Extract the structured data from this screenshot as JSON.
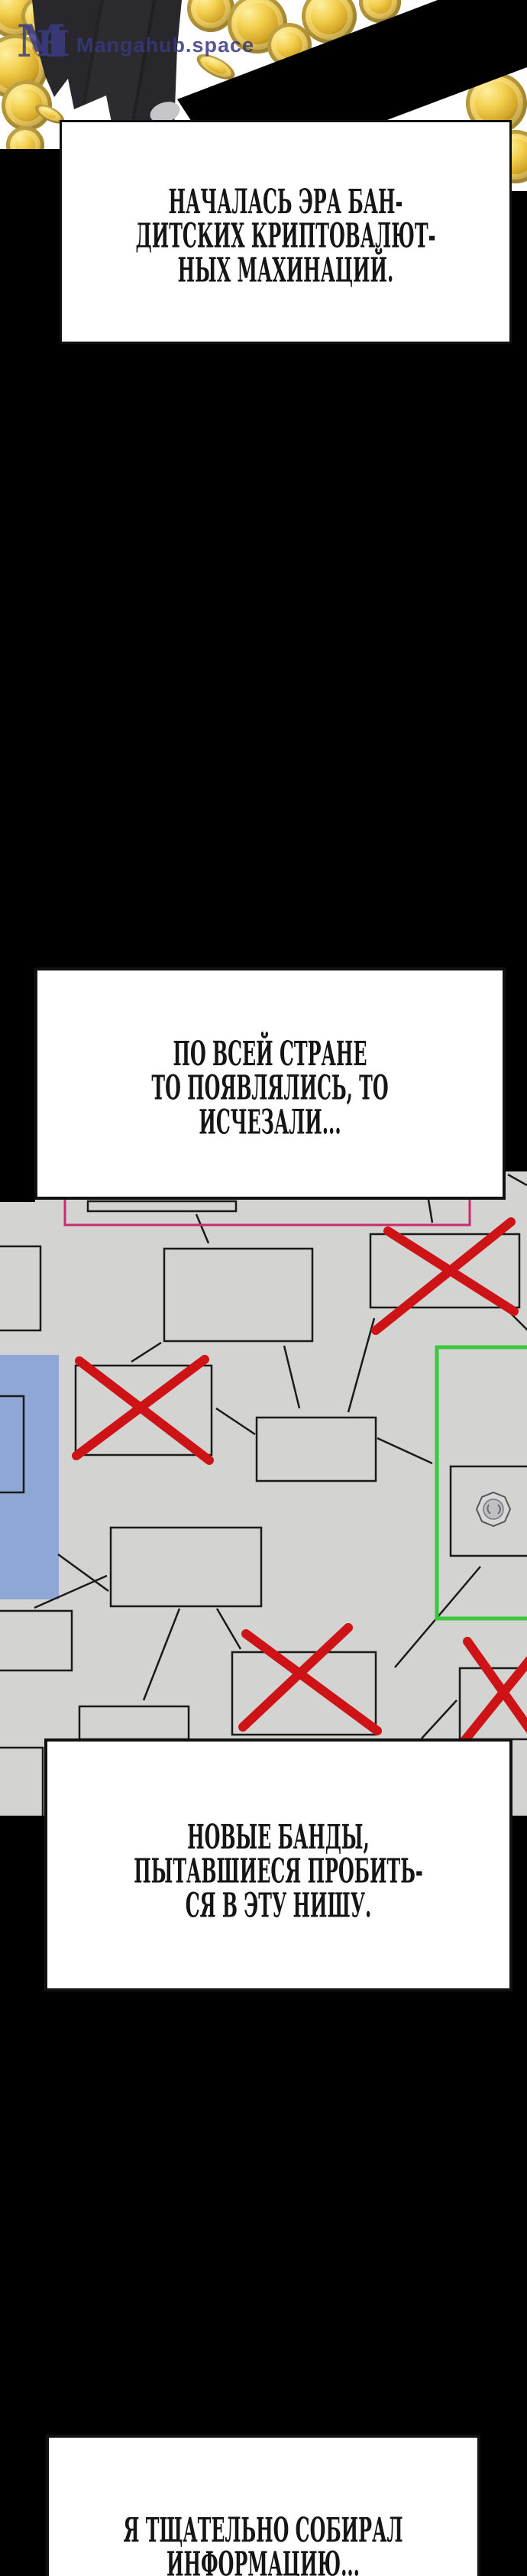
{
  "watermark": {
    "logo": "MH",
    "site": "Mangahub.space"
  },
  "captions": {
    "box1": {
      "lines": [
        "НАЧАЛАСЬ ЭРА БАН-",
        "ДИТСКИХ КРИПТОВАЛЮТ-",
        "НЫХ МАХИНАЦИЙ."
      ]
    },
    "box2": {
      "lines": [
        "ПО ВСЕЙ СТРАНЕ",
        "ТО ПОЯВЛЯЛИСЬ, ТО",
        "ИСЧЕЗАЛИ..."
      ]
    },
    "box3": {
      "lines": [
        "НОВЫЕ БАНДЫ,",
        "ПЫТАВШИЕСЯ ПРОБИТЬ-",
        "СЯ В ЭТУ НИШУ."
      ]
    },
    "box4": {
      "lines": [
        "Я ТЩАТЕЛЬНО СОБИРАЛ",
        "ИНФОРМАЦИЮ..."
      ]
    }
  },
  "scene": {
    "top_panel": "figure in black suit over falling gold coins, black diagonal band",
    "diagram_panel": "network of boxes: four crossed out in red, one blue highlighted strip, one green-framed box with coin, one pink frame"
  },
  "colors": {
    "page_bg": "#000000",
    "panel_bg": "#d3d3d1",
    "caption_bg": "#ffffff",
    "caption_text": "#151515",
    "coin_gold": "#e7c244",
    "cross_red": "#ce1317",
    "frame_pink": "#c92a70",
    "frame_green": "#3ec73e",
    "highlight_blue": "#8fa7d4",
    "watermark_blue": "#3b3b85"
  }
}
